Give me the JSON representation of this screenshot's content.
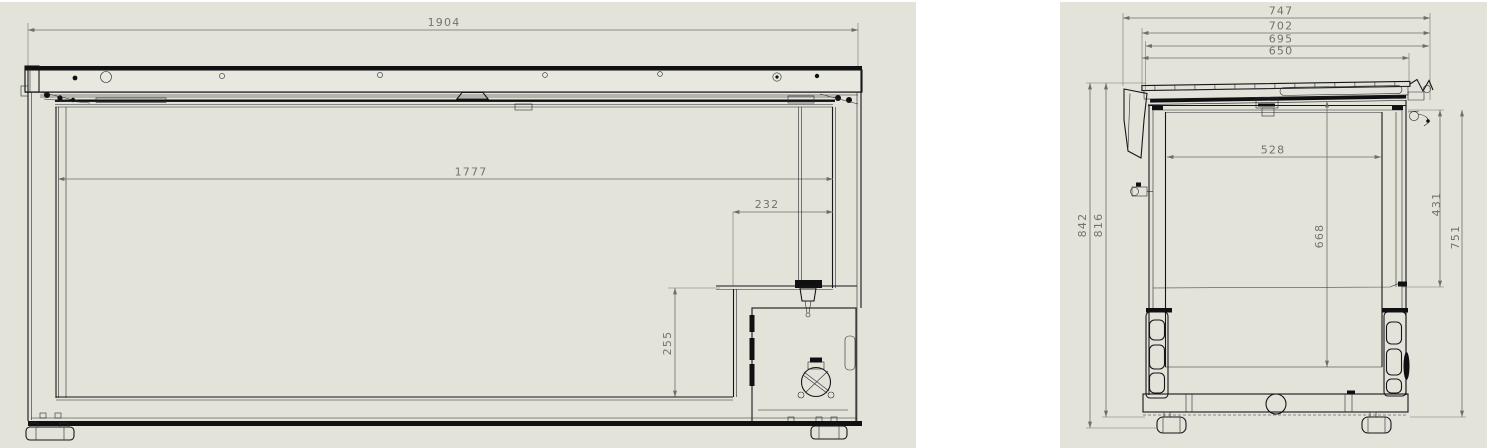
{
  "drawing": {
    "title": "chest freezer sectional drawing",
    "background_color": "#ffffff",
    "panel_color": "#e3e3da",
    "geometry_color": "#16161a",
    "dimension_color": "#73736a"
  },
  "front_view": {
    "label": "front section view",
    "dims": {
      "overall_width": "1904",
      "interior_width": "1777",
      "machine_compartment_width": "232",
      "machine_compartment_height": "255"
    }
  },
  "side_view": {
    "label": "side section view",
    "dims": {
      "overall_depth_with_handle": "747",
      "lid_depth": "702",
      "body_depth": "695",
      "opening_depth": "650",
      "interior_depth": "528",
      "upper_panel_height": "431",
      "interior_height": "668",
      "front_panel_height": "751",
      "overall_height": "842",
      "body_height": "816"
    }
  }
}
